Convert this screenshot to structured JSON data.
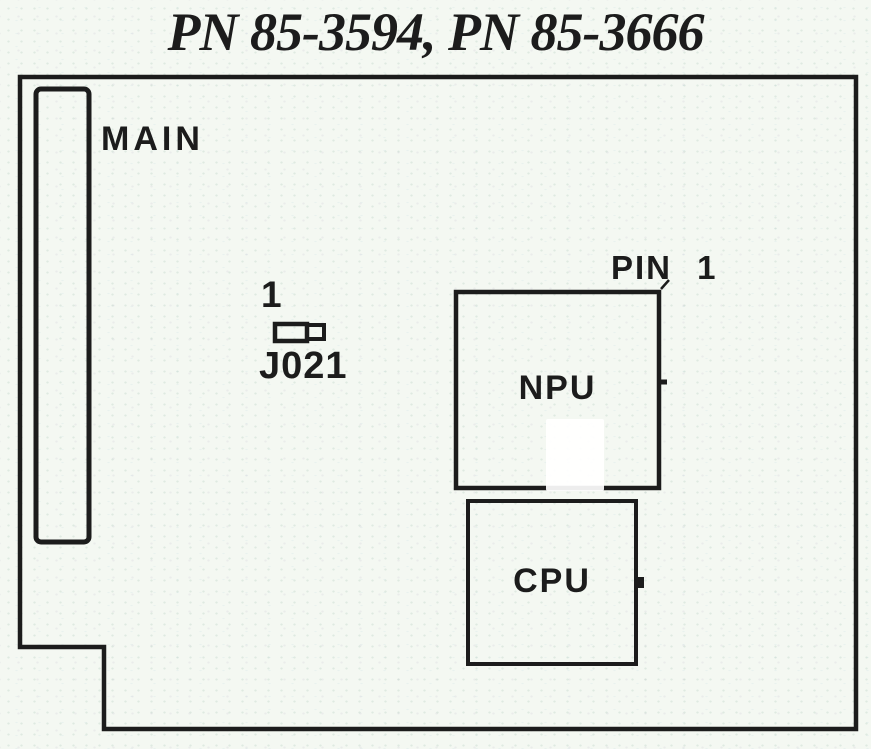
{
  "title": "PN 85-3594, PN 85-3666",
  "colors": {
    "ink": "#1c1c1c",
    "paper": "#f4f8f2"
  },
  "diagram": {
    "connector": {
      "label": "MAIN"
    },
    "jumper": {
      "pin_label": "1",
      "name": "J021"
    },
    "npu": {
      "label": "NPU",
      "pin_label": "PIN 1"
    },
    "cpu": {
      "label": "CPU"
    }
  }
}
